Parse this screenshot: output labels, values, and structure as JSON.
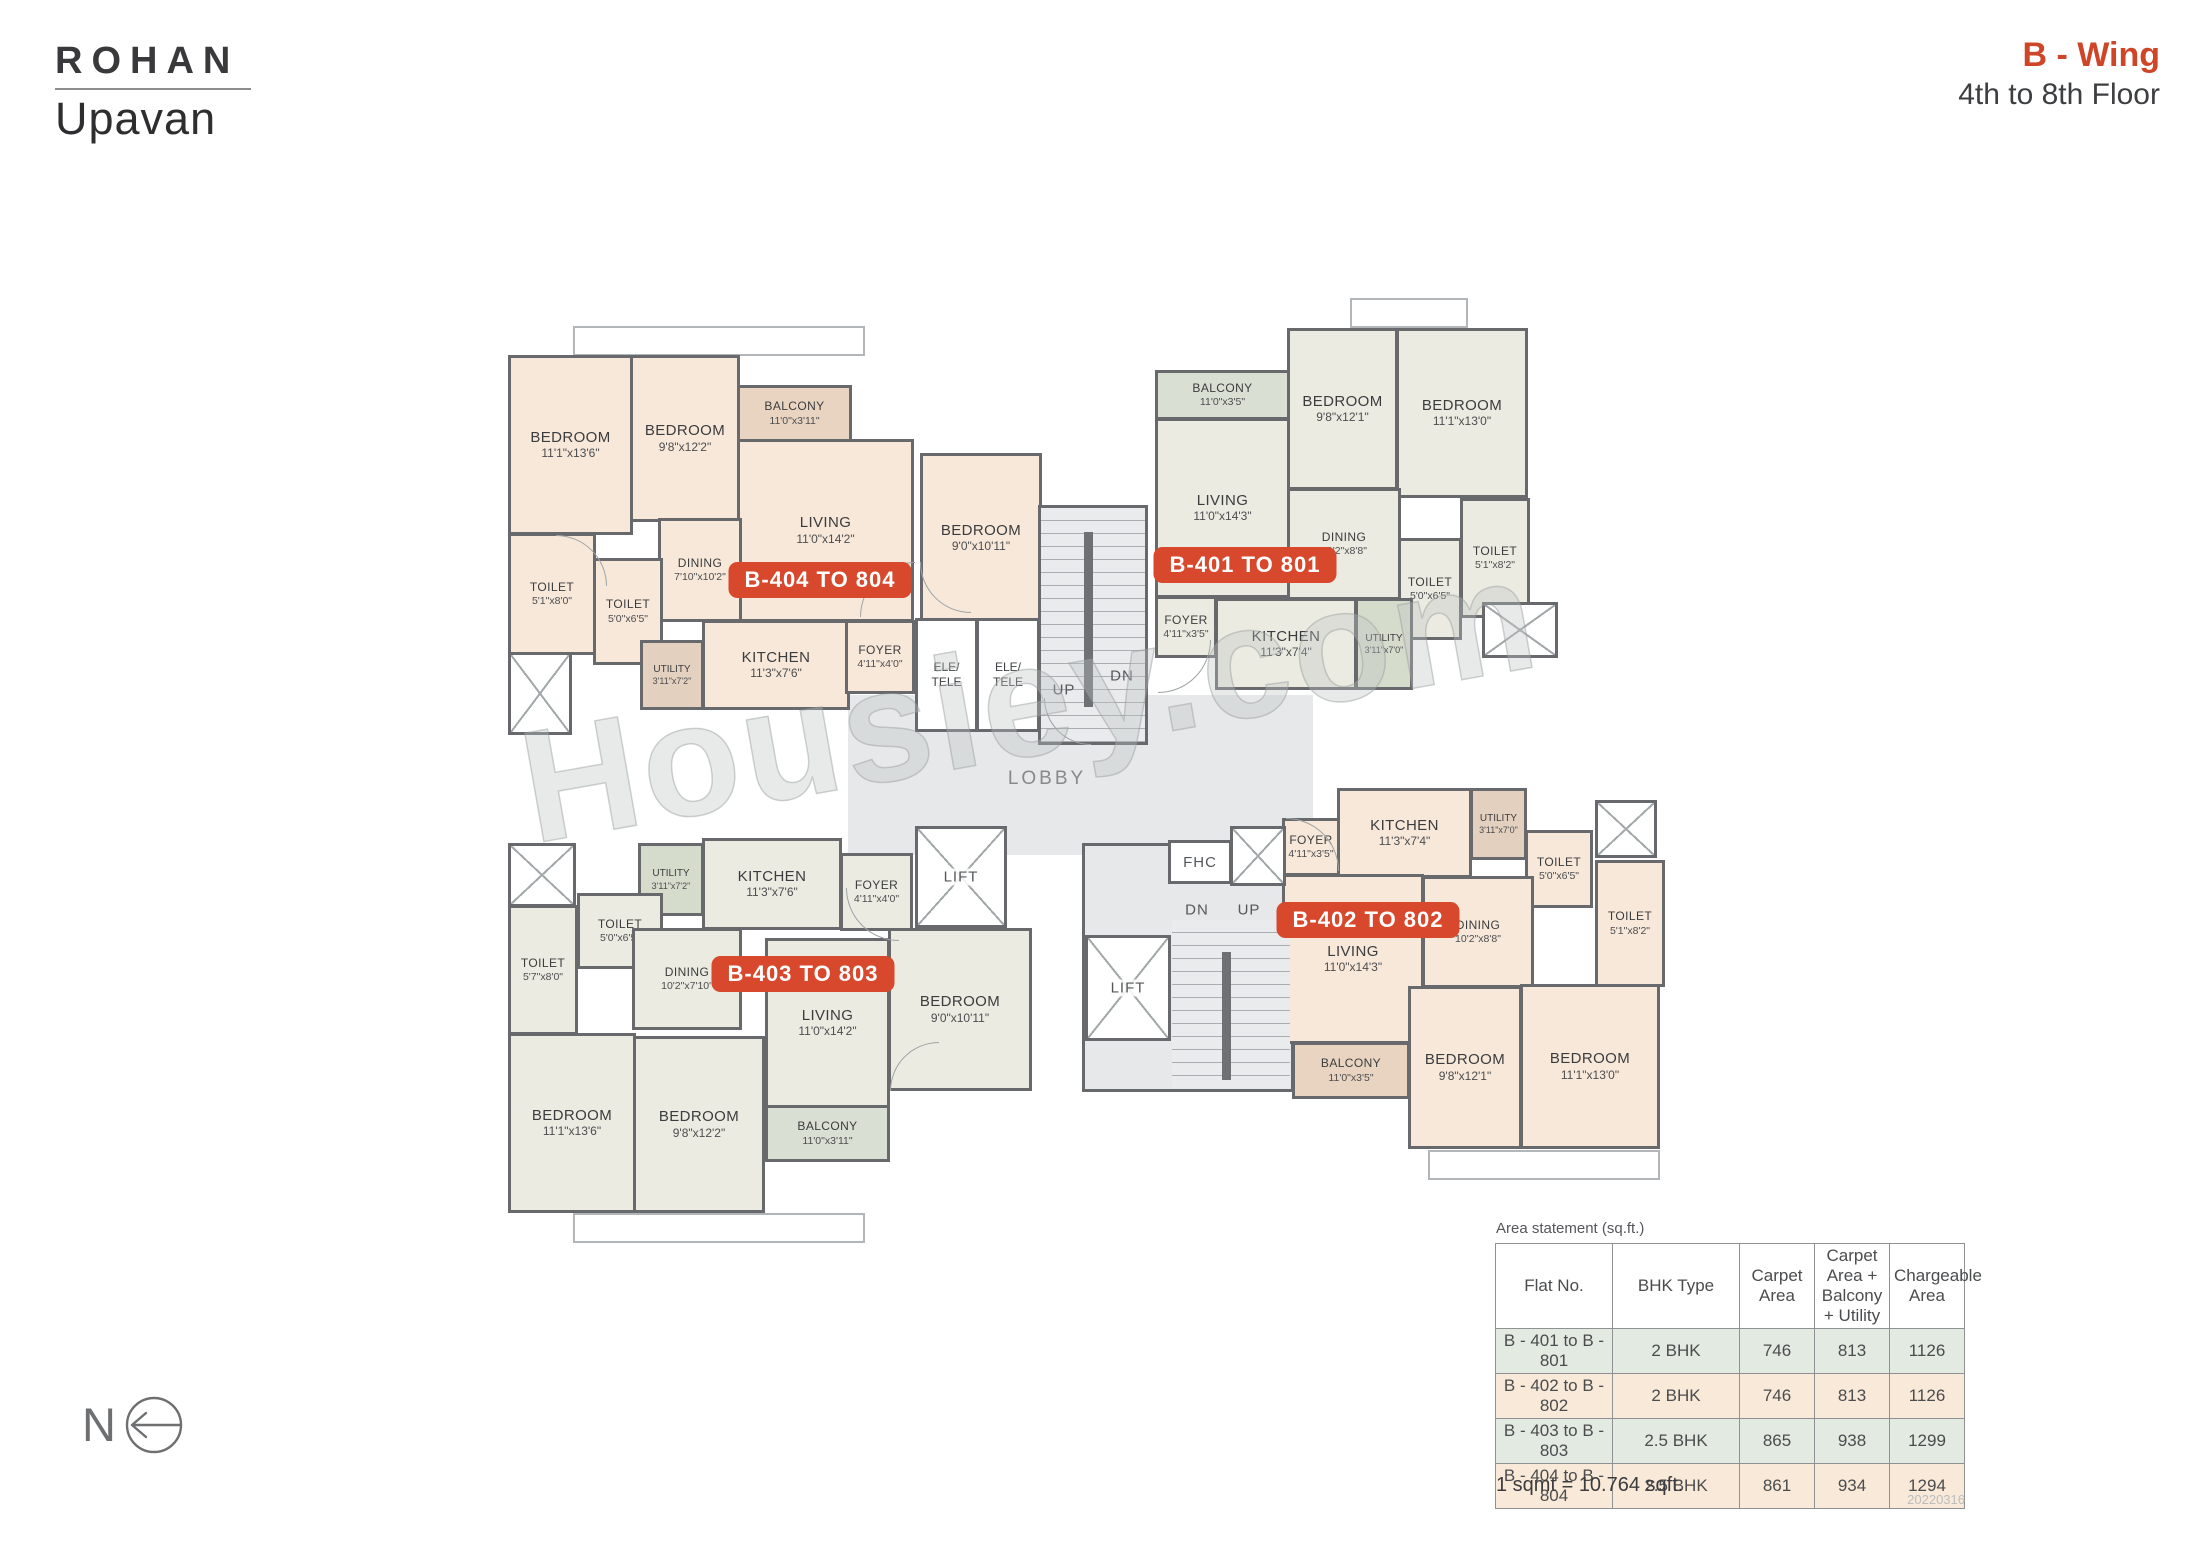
{
  "header": {
    "brand_line1": "ROHAN",
    "brand_line2": "Upavan",
    "wing": "B - Wing",
    "floors": "4th to 8th Floor"
  },
  "watermark": "Housiey.com",
  "north_label": "N",
  "core": {
    "lobby": "LOBBY",
    "fhc": "FHC",
    "lift": "LIFT",
    "up": "UP",
    "dn": "DN",
    "ele": "ELE/",
    "tele": "TELE"
  },
  "units": [
    {
      "id": "B-404",
      "badge": "B-404 TO 804",
      "rooms": [
        {
          "name": "BEDROOM",
          "dims": "11'1\"x13'6\""
        },
        {
          "name": "BEDROOM",
          "dims": "9'8\"x12'2\""
        },
        {
          "name": "BALCONY",
          "dims": "11'0\"x3'11\""
        },
        {
          "name": "LIVING",
          "dims": "11'0\"x14'2\""
        },
        {
          "name": "BEDROOM",
          "dims": "9'0\"x10'11\""
        },
        {
          "name": "DINING",
          "dims": "7'10\"x10'2\""
        },
        {
          "name": "TOILET",
          "dims": "5'1\"x8'0\""
        },
        {
          "name": "TOILET",
          "dims": "5'0\"x6'5\""
        },
        {
          "name": "UTILITY",
          "dims": "3'11\"x7'2\""
        },
        {
          "name": "KITCHEN",
          "dims": "11'3\"x7'6\""
        },
        {
          "name": "FOYER",
          "dims": "4'11\"x4'0\""
        }
      ]
    },
    {
      "id": "B-401",
      "badge": "B-401 TO 801",
      "rooms": [
        {
          "name": "BALCONY",
          "dims": "11'0\"x3'5\""
        },
        {
          "name": "LIVING",
          "dims": "11'0\"x14'3\""
        },
        {
          "name": "BEDROOM",
          "dims": "9'8\"x12'1\""
        },
        {
          "name": "BEDROOM",
          "dims": "11'1\"x13'0\""
        },
        {
          "name": "DINING",
          "dims": "10'2\"x8'8\""
        },
        {
          "name": "TOILET",
          "dims": "5'1\"x8'2\""
        },
        {
          "name": "TOILET",
          "dims": "5'0\"x6'5\""
        },
        {
          "name": "FOYER",
          "dims": "4'11\"x3'5\""
        },
        {
          "name": "KITCHEN",
          "dims": "11'3\"x7'4\""
        },
        {
          "name": "UTILITY",
          "dims": "3'11\"x7'0\""
        }
      ]
    },
    {
      "id": "B-403",
      "badge": "B-403 TO 803",
      "rooms": [
        {
          "name": "UTILITY",
          "dims": "3'11\"x7'2\""
        },
        {
          "name": "KITCHEN",
          "dims": "11'3\"x7'6\""
        },
        {
          "name": "FOYER",
          "dims": "4'11\"x4'0\""
        },
        {
          "name": "TOILET",
          "dims": "5'0\"x6'5\""
        },
        {
          "name": "TOILET",
          "dims": "5'7\"x8'0\""
        },
        {
          "name": "DINING",
          "dims": "10'2\"x7'10\""
        },
        {
          "name": "BEDROOM",
          "dims": "9'0\"x10'11\""
        },
        {
          "name": "LIVING",
          "dims": "11'0\"x14'2\""
        },
        {
          "name": "BEDROOM",
          "dims": "11'1\"x13'6\""
        },
        {
          "name": "BEDROOM",
          "dims": "9'8\"x12'2\""
        },
        {
          "name": "BALCONY",
          "dims": "11'0\"x3'11\""
        }
      ]
    },
    {
      "id": "B-402",
      "badge": "B-402 TO 802",
      "rooms": [
        {
          "name": "FOYER",
          "dims": "4'11\"x3'5\""
        },
        {
          "name": "KITCHEN",
          "dims": "11'3\"x7'4\""
        },
        {
          "name": "UTILITY",
          "dims": "3'11\"x7'0\""
        },
        {
          "name": "TOILET",
          "dims": "5'0\"x6'5\""
        },
        {
          "name": "TOILET",
          "dims": "5'1\"x8'2\""
        },
        {
          "name": "DINING",
          "dims": "10'2\"x8'8\""
        },
        {
          "name": "LIVING",
          "dims": "11'0\"x14'3\""
        },
        {
          "name": "BALCONY",
          "dims": "11'0\"x3'5\""
        },
        {
          "name": "BEDROOM",
          "dims": "9'8\"x12'1\""
        },
        {
          "name": "BEDROOM",
          "dims": "11'1\"x13'0\""
        }
      ]
    }
  ],
  "area_table": {
    "title": "Area statement (sq.ft.)",
    "headers": [
      "Flat No.",
      "BHK Type",
      "Carpet Area",
      "Carpet Area + Balcony + Utility",
      "Chargeable Area"
    ],
    "rows": [
      [
        "B - 401 to B - 801",
        "2 BHK",
        "746",
        "813",
        "1126"
      ],
      [
        "B - 402 to B - 802",
        "2 BHK",
        "746",
        "813",
        "1126"
      ],
      [
        "B - 403 to B - 803",
        "2.5 BHK",
        "865",
        "938",
        "1299"
      ],
      [
        "B - 404 to B - 804",
        "2.5 BHK",
        "861",
        "934",
        "1294"
      ]
    ]
  },
  "footnote": "1 sqmt = 10.764 sqft.",
  "date_code": "20220316",
  "colors": {
    "accent": "#d7482c",
    "wall": "#67696c",
    "unit_peach": "#f7e8da",
    "unit_sage": "#ebebe1",
    "balcony_tan": "#e9d4c1",
    "balcony_sage": "#d9dfd2",
    "core_gray": "#e6e8e9",
    "row_green": "#e3eae1",
    "row_peach": "#f8e9d9"
  }
}
